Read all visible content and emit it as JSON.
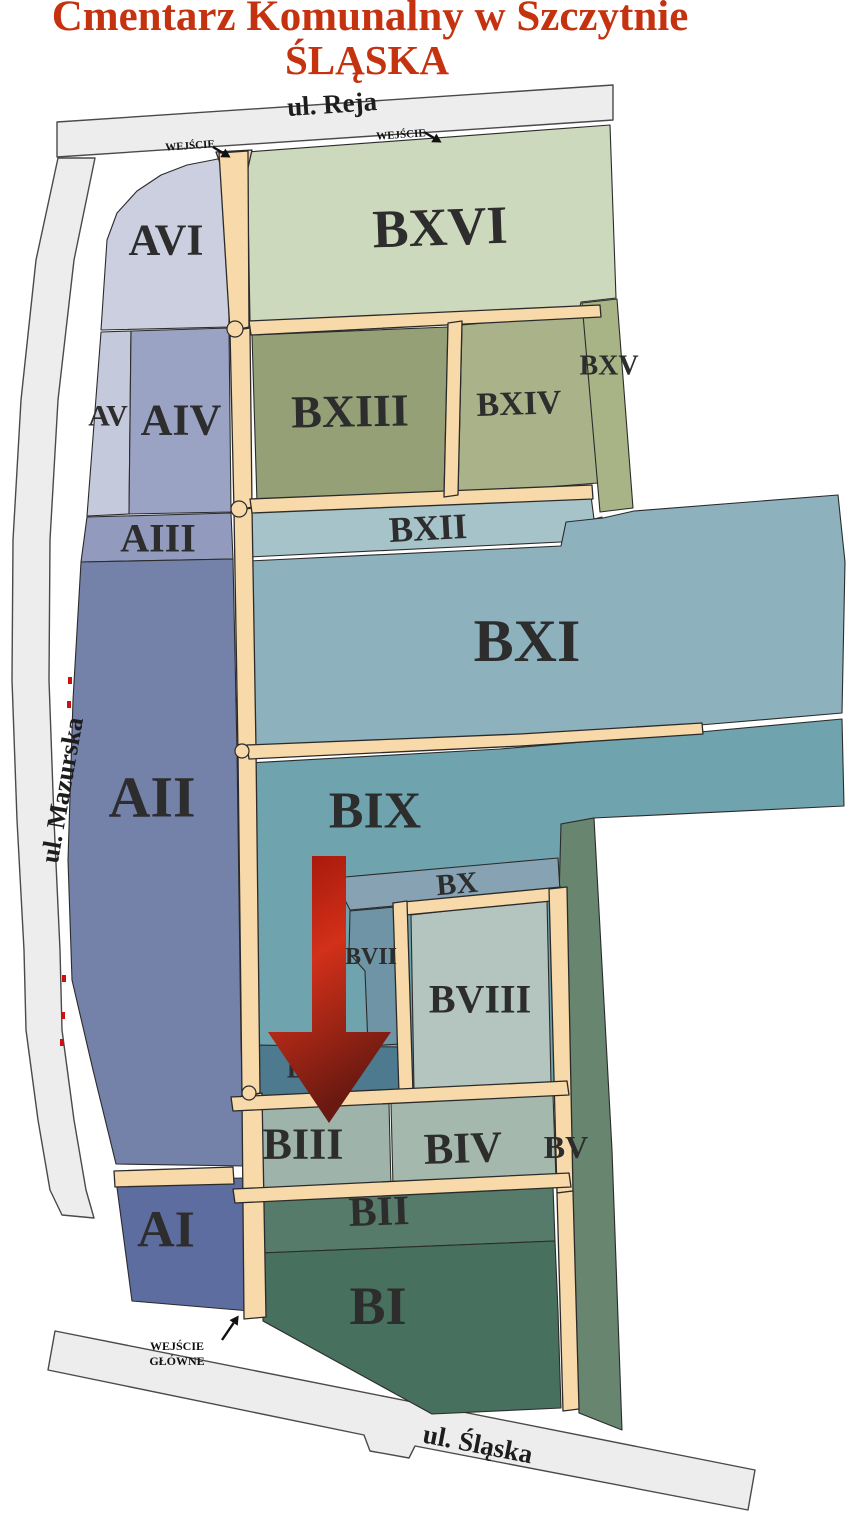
{
  "title": {
    "line1": "Cmentarz Komunalny w Szczytnie",
    "line2": "ŚLĄSKA",
    "color": "#c5320f"
  },
  "map": {
    "styles": {
      "road_fill": "#ededed",
      "road_stroke": "#4a4a4a",
      "path_fill": "#f8d9a9",
      "path_stroke": "#2b2b2b",
      "section_stroke": "#2b2b2b",
      "label_color": "#2d2d2d",
      "entrance_color": "#111111",
      "gate_color": "#cc1111"
    },
    "roads": [
      {
        "id": "ul-reja",
        "label": "ul. Reja",
        "points": "57,122 613,85 613,120 57,157",
        "label_pos": [
          332,
          104
        ],
        "label_rot": -3.8,
        "label_fs": 27
      },
      {
        "id": "ul-mazurska",
        "label": "ul. Mazurska",
        "points": "95,158 74,260 58,400 50,540 49,680 54,820 60,950 62,1030 74,1120 86,1190 94,1218 62,1215 50,1190 38,1120 26,1030 24,950 17,820 12,680 13,540 21,400 36,260 58,158",
        "label_pos": [
          62,
          790
        ],
        "label_rot": -80,
        "label_fs": 26
      },
      {
        "id": "ul-slaska",
        "label": "ul. Śląska",
        "points": "55,1331 755,1470 748,1510 415,1446 409,1458 370,1451 364,1435 48,1370",
        "label_pos": [
          478,
          1444
        ],
        "label_rot": 11,
        "label_fs": 27
      }
    ],
    "sections": [
      {
        "id": "avi",
        "label": "AVI",
        "fill": "#cbcfe0",
        "points": "107,240 117,213 137,191 161,175 187,165 228,157 229,327 101,330",
        "label_pos": [
          166,
          240
        ],
        "label_fs": 44,
        "label_rot": 0
      },
      {
        "id": "bxvi",
        "label": "BXVI",
        "fill": "#cdd9bc",
        "points": "247,152 610,125 616,298 581,302 579,311 250,321",
        "label_pos": [
          440,
          227
        ],
        "label_fs": 54,
        "label_rot": -2
      },
      {
        "id": "av",
        "label": "AV",
        "fill": "#c4c9dc",
        "points": "101,332 131,331 129,514 87,516",
        "label_pos": [
          108,
          416
        ],
        "label_fs": 30,
        "label_rot": 0
      },
      {
        "id": "aiv",
        "label": "AIV",
        "fill": "#9aa3c4",
        "points": "131,331 229,328 231,512 129,514",
        "label_pos": [
          181,
          420
        ],
        "label_fs": 44,
        "label_rot": 0
      },
      {
        "id": "bxiii",
        "label": "BXIII",
        "fill": "#95a077",
        "points": "252,335 448,327 444,495 257,503",
        "label_pos": [
          350,
          411
        ],
        "label_fs": 46,
        "label_rot": -1
      },
      {
        "id": "bxiv",
        "label": "BXIV",
        "fill": "#a9b288",
        "points": "462,325 593,313 598,483 458,494",
        "label_pos": [
          519,
          404
        ],
        "label_fs": 34,
        "label_rot": -2
      },
      {
        "id": "bxv",
        "label": "BXV",
        "fill": "#a8b485",
        "points": "582,303 617,299 633,508 600,512",
        "label_pos": [
          609,
          366
        ],
        "label_fs": 28,
        "label_rot": 0
      },
      {
        "id": "aiii",
        "label": "AIII",
        "fill": "#929bbd",
        "points": "87,517 231,513 233,559 81,562",
        "label_pos": [
          158,
          538
        ],
        "label_fs": 40,
        "label_rot": 0
      },
      {
        "id": "bxii",
        "label": "BXII",
        "fill": "#a5c3c8",
        "points": "250,512 591,496 594,519 602,517 604,539 561,542 249,557",
        "label_pos": [
          428,
          528
        ],
        "label_fs": 36,
        "label_rot": -3
      },
      {
        "id": "bxi",
        "label": "BXI",
        "fill": "#8db2bd",
        "points": "249,561 561,546 566,522 603,518 634,511 838,495 845,562 842,713 700,725 500,738 247,749",
        "label_pos": [
          527,
          641
        ],
        "label_fs": 60,
        "label_rot": 0
      },
      {
        "id": "aii",
        "label": "AII",
        "fill": "#7481a8",
        "points": "81,562 233,559 237,750 241,1040 245,1166 116,1164 93,1070 72,980 68,860 73,700",
        "label_pos": [
          152,
          797
        ],
        "label_fs": 58,
        "label_rot": 0
      },
      {
        "id": "bix",
        "label": "BIX",
        "fill": "#6fa3ae",
        "points": "249,763 500,749 700,732 842,719 844,806 594,818 561,824 566,1086 251,1099",
        "label_pos": [
          375,
          811
        ],
        "label_fs": 52,
        "label_rot": 0
      },
      {
        "id": "bv",
        "label": "BV",
        "fill": "#67856f",
        "points": "561,824 594,818 612,1150 622,1430 579,1413 567,1190 559,898",
        "label_pos": [
          566,
          1147
        ],
        "label_fs": 32,
        "label_rot": 0
      },
      {
        "id": "bx",
        "label": "BX",
        "fill": "#87a2b3",
        "points": "334,878 558,858 560,891 350,910",
        "label_pos": [
          457,
          884
        ],
        "label_fs": 30,
        "label_rot": -5
      },
      {
        "id": "bvii",
        "label": "BVII",
        "fill": "#6e94a5",
        "points": "350,911 395,907 400,1044 368,1046 365,971 349,953",
        "label_pos": [
          371,
          957
        ],
        "label_fs": 24,
        "label_rot": 0
      },
      {
        "id": "bvi",
        "label": "BVI",
        "fill": "#4d7a8f",
        "points": "251,1045 400,1047 401,1091 253,1097",
        "label_pos": [
          310,
          1069
        ],
        "label_fs": 26,
        "label_rot": 0
      },
      {
        "id": "bviii",
        "label": "BVIII",
        "fill": "#b4c4be",
        "points": "411,915 547,900 551,1084 414,1091",
        "label_pos": [
          480,
          999
        ],
        "label_fs": 40,
        "label_rot": 0
      },
      {
        "id": "biii",
        "label": "BIII",
        "fill": "#9eb3a9",
        "points": "255,1109 389,1103 391,1187 258,1195",
        "label_pos": [
          303,
          1144
        ],
        "label_fs": 44,
        "label_rot": 0
      },
      {
        "id": "biv",
        "label": "BIV",
        "fill": "#a4b8ad",
        "points": "391,1103 553,1095 556,1179 393,1187",
        "label_pos": [
          463,
          1148
        ],
        "label_fs": 44,
        "label_rot": -2
      },
      {
        "id": "bii",
        "label": "BII",
        "fill": "#567b6b",
        "points": "259,1201 553,1187 555,1241 261,1253",
        "label_pos": [
          379,
          1212
        ],
        "label_fs": 42,
        "label_rot": -2
      },
      {
        "id": "bi",
        "label": "BI",
        "fill": "#47705f",
        "points": "261,1253 555,1241 558,1311 561,1408 432,1414 263,1321",
        "label_pos": [
          378,
          1306
        ],
        "label_fs": 54,
        "label_rot": 0
      },
      {
        "id": "ai",
        "label": "AI",
        "fill": "#5e6da0",
        "points": "116,1180 246,1178 250,1311 132,1301",
        "label_pos": [
          166,
          1230
        ],
        "label_fs": 52,
        "label_rot": 0
      }
    ],
    "walkways": [
      "216,152 252,150 247,172 224,174",
      "219,153 248,151 249,327 230,331",
      "230,331 250,328 252,507 234,511",
      "234,511 252,508 256,749 238,753",
      "238,753 256,749 260,1093 242,1097",
      "242,1097 262,1093 266,1317 244,1319",
      "249,321 600,305 601,317 251,335",
      "250,499 592,485 593,499 252,513",
      "448,323 462,321 458,495 444,497",
      "247,745 520,734 702,723 703,734 521,746 249,759",
      "393,903 561,887 562,900 395,916",
      "393,903 407,901 413,1093 399,1095",
      "549,889 567,887 573,1191 557,1193",
      "557,1193 573,1191 579,1409 563,1411",
      "231,1097 567,1081 569,1095 233,1111",
      "233,1189 569,1173 571,1187 235,1203",
      "114,1171 233,1167 234,1184 115,1187"
    ],
    "junctions": [
      [
        235,
        329,
        8
      ],
      [
        239,
        509,
        8
      ],
      [
        242,
        751,
        7
      ],
      [
        249,
        1093,
        7
      ]
    ],
    "gate_markers": [
      [
        70,
        680
      ],
      [
        69,
        704
      ],
      [
        64,
        978
      ],
      [
        63,
        1015
      ],
      [
        62,
        1042
      ]
    ],
    "entrances": [
      {
        "id": "north-west",
        "lines": [
          "WEJŚCIE"
        ],
        "pos": [
          190,
          146
        ],
        "rot": -4,
        "fs": 11,
        "line_h": 13,
        "arrow": {
          "from": [
            213,
            147
          ],
          "to": [
            228,
            156
          ]
        }
      },
      {
        "id": "north",
        "lines": [
          "WEJŚCIE"
        ],
        "pos": [
          401,
          135
        ],
        "rot": -4,
        "fs": 11,
        "line_h": 13,
        "arrow": {
          "from": [
            424,
            132
          ],
          "to": [
            439,
            141
          ]
        }
      },
      {
        "id": "main",
        "lines": [
          "WEJŚCIE",
          "GŁÓWNE"
        ],
        "pos": [
          177,
          1346
        ],
        "rot": 0,
        "fs": 12,
        "line_h": 15,
        "arrow": {
          "from": [
            222,
            1340
          ],
          "to": [
            237,
            1318
          ]
        }
      }
    ],
    "marker": {
      "points": "312,856 346,856 346,1032 391,1032 329,1123 268,1032 312,1032",
      "gradient": [
        [
          "0%",
          "#9d1409"
        ],
        [
          "45%",
          "#d23019"
        ],
        [
          "100%",
          "#691911"
        ]
      ]
    }
  }
}
